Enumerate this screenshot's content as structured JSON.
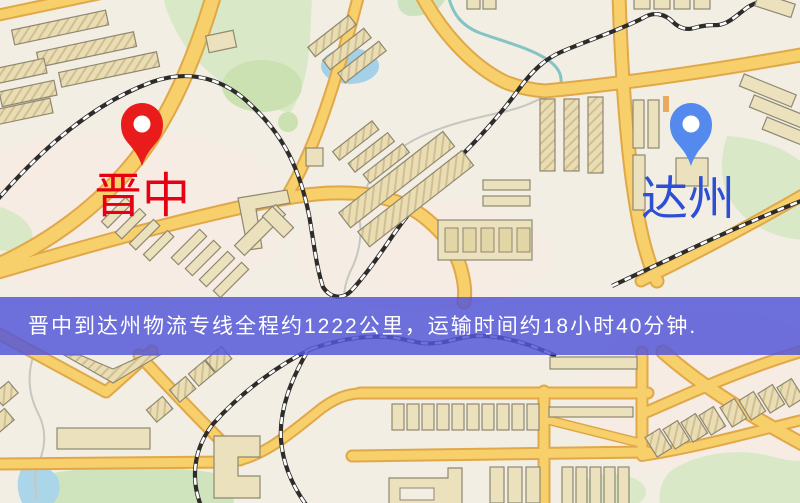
{
  "banner": {
    "text": "晋中到达州物流专线全程约1222公里，运输时间约18小时40分钟.",
    "distance_km": "1222",
    "duration_hours": "18",
    "duration_minutes": "40",
    "bg_color": "rgba(84,86,216,0.84)",
    "text_color": "#ffffff"
  },
  "origin": {
    "label": "晋中",
    "label_color": "#e60012",
    "pin_color": "#ea1b1b",
    "pin_hole_color": "#ffffff"
  },
  "destination": {
    "label": "达州",
    "label_color": "#2c4fd4",
    "pin_color": "#5489ee",
    "pin_hole_color": "#ffffff"
  }
}
